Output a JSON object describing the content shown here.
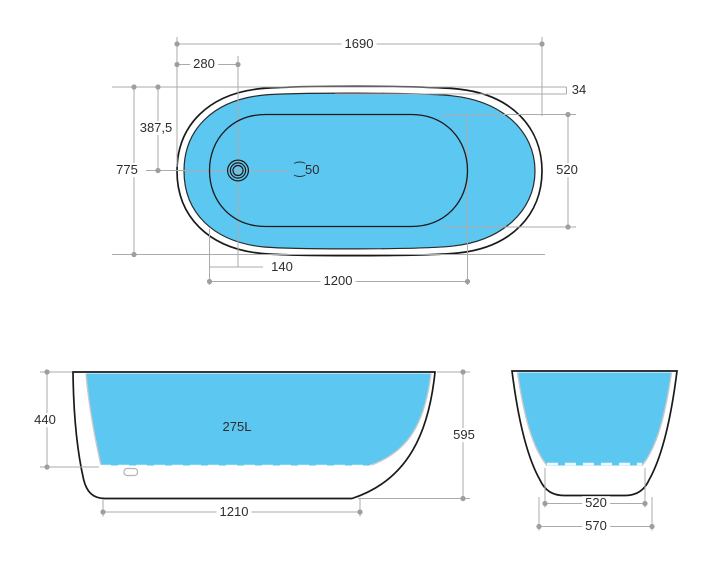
{
  "colors": {
    "water_fill": "#5CC7F0",
    "outline": "#1A1A1A",
    "dimension_line": "#ABABAB",
    "dimension_dot": "#9E9E9E",
    "inner_wall": "#C9C9C9",
    "label_text": "#2D2D2D"
  },
  "top_view": {
    "overall_length": "1690",
    "drain_offset_from_end": "280",
    "rim_width": "34",
    "drain_offset_from_side": "387,5",
    "overall_width": "775",
    "drain_diameter": "⁐50",
    "basin_width": "520",
    "drain_from_basin_end": "140",
    "basin_length": "1200"
  },
  "side_view": {
    "inner_depth": "440",
    "capacity": "275L",
    "overall_height": "595",
    "base_length": "1210"
  },
  "end_view": {
    "basin_floor_width": "520",
    "base_width": "570"
  }
}
